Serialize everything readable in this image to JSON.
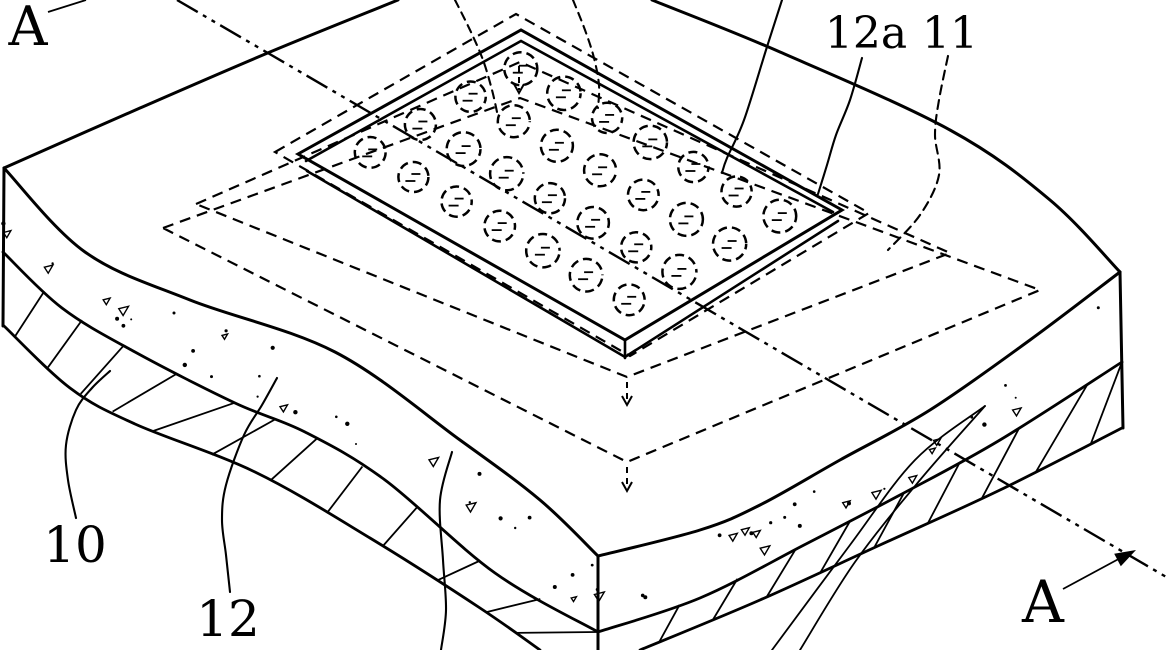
{
  "figure": {
    "kind": "patent-isometric-line-drawing",
    "ink": "#000000",
    "paper": "#ffffff",
    "section_line": "A-A",
    "labels": {
      "a_top_left": "A",
      "a_bottom_right": "A",
      "ref_12a": "12a",
      "ref_11": "11",
      "ref_10": "10",
      "ref_12": "12"
    },
    "stud_grid": {
      "rows": 4,
      "cols": 7,
      "count": 28
    }
  }
}
